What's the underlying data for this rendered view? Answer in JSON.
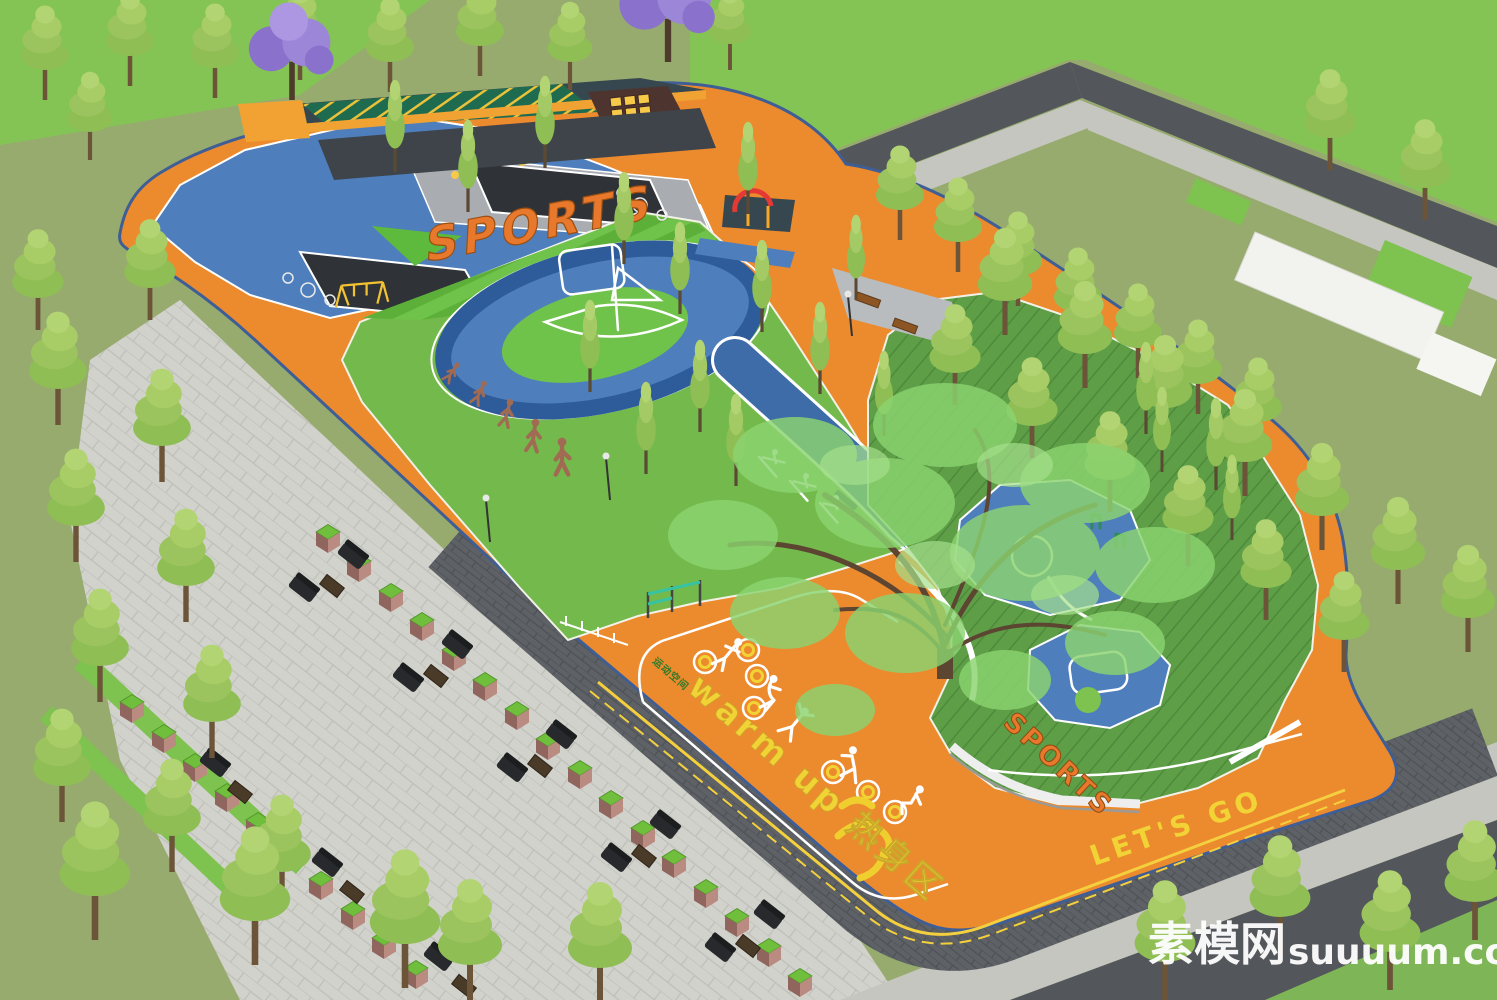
{
  "signs": {
    "sports_lawn": "SPORTS",
    "warm_up": "warm up 热身区",
    "lets_go": "LET'S GO",
    "sports_hedge": "SPORTS",
    "track_label_small": "运动空间"
  },
  "watermark": {
    "site_cn": "素模网",
    "site_en": "suuuum.com"
  },
  "colors": {
    "track_orange": "#EC8A2E",
    "track_edge_blue": "#3F5E95",
    "play_blue": "#4E7FBC",
    "ring_blue": "#3A66A0",
    "stream_blue": "#3E6CA8",
    "lawn_green": "#74B94C",
    "lawn_bright": "#66BE3F",
    "mound_green": "#5E9E47",
    "field_olive": "#97AB6F",
    "field_bright": "#84C455",
    "road_dark": "#53575B",
    "sidewalk_light": "#C6C6C0",
    "walkway_dark": "#5E6266",
    "paving_light": "#D2D2CC",
    "sign_yellow": "#F2D335",
    "sports_orange": "#E8782C",
    "figure_white": "#FFFFFF",
    "evolution_brown": "#A06B52",
    "jacaranda_purple": "#9C86D8",
    "tree_green": "#9CC45E",
    "big_tree_green": "#8BD470",
    "planter_pink": "#BA8B81",
    "planter_top": "#6FBE3C",
    "sofa_dark": "#27292C",
    "watermark_white": "#FFFFFF"
  }
}
